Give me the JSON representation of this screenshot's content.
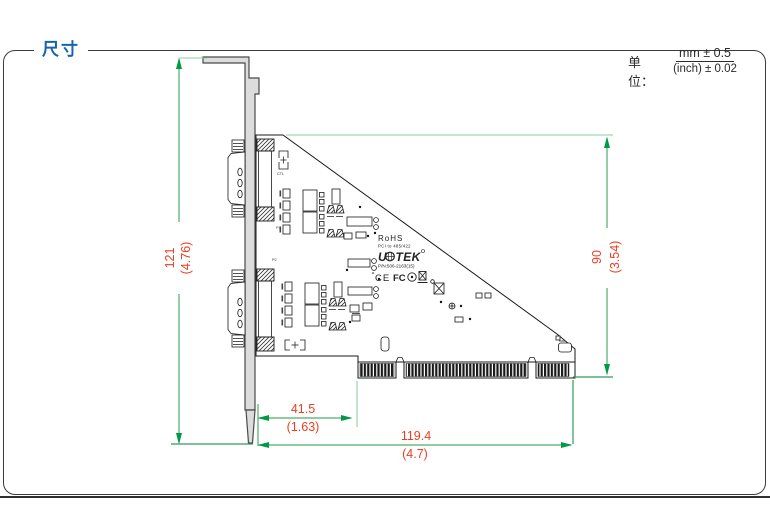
{
  "header": {
    "title": "尺寸"
  },
  "unit": {
    "label": "单位：",
    "mm": "mm ± 0.5",
    "inch": "(inch) ± 0.02"
  },
  "dims": {
    "bracket_height_mm": "121",
    "bracket_height_in": "(4.76)",
    "pcb_height_mm": "90",
    "pcb_height_in": "(3.54)",
    "offset_mm": "41.5",
    "offset_in": "(1.63)",
    "length_mm": "119.4",
    "length_in": "(4.7)"
  },
  "pcb_text": {
    "rohs": "RoHS",
    "model": "PCI to 485/422",
    "brand_u": "U",
    "brand_tek": "TEK",
    "part_number": "P/N:506-2163(15)",
    "ce": "CE",
    "fcc": "FC",
    "p1": "P1",
    "p2": "P2",
    "ctl": "CTL"
  },
  "colors": {
    "accent_blue": "#1b63b0",
    "dim_line_green": "#4cae68",
    "dim_arrow_green": "#009a47",
    "dim_text_red": "#ee3d23",
    "bracket_fill": "#dcdcdc"
  }
}
